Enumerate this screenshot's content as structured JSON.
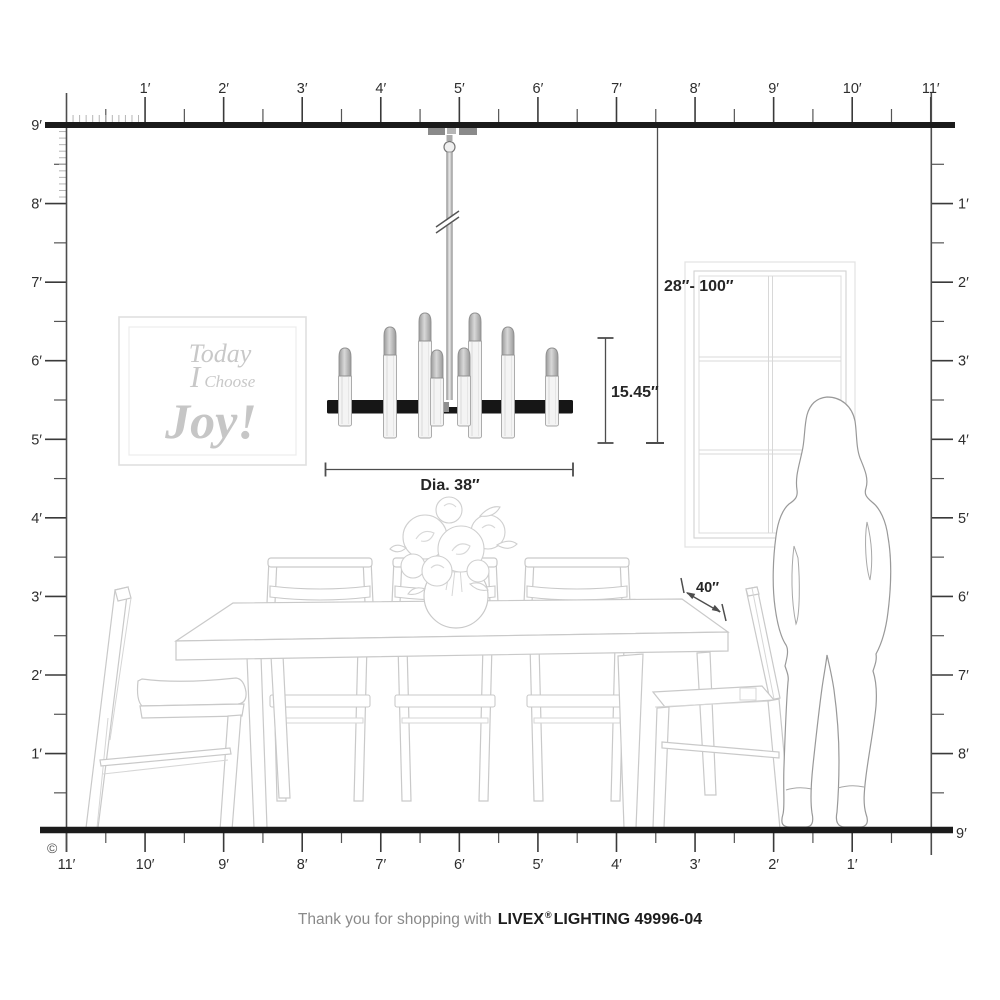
{
  "product": {
    "diagram_type": "chandelier room scale diagram",
    "room_height_feet": 9,
    "room_width_feet": 11
  },
  "rulers": {
    "top": [
      "1′",
      "2′",
      "3′",
      "4′",
      "5′",
      "6′",
      "7′",
      "8′",
      "9′",
      "10′",
      "11′"
    ],
    "left": [
      "9′",
      "8′",
      "7′",
      "6′",
      "5′",
      "4′",
      "3′",
      "2′",
      "1′"
    ],
    "right": [
      "1′",
      "2′",
      "3′",
      "4′",
      "5′",
      "6′",
      "7′",
      "8′",
      "9′"
    ],
    "bottom": [
      "11′",
      "10′",
      "9′",
      "8′",
      "7′",
      "6′",
      "5′",
      "4′",
      "3′",
      "2′",
      "1′"
    ],
    "bottom_right": "9′"
  },
  "dimensions": {
    "hanging_range": "28″- 100″",
    "fixture_height": "15.45″",
    "fixture_diameter": "Dia. 38″",
    "table_depth": "40″"
  },
  "wall_art": {
    "line1": "Today",
    "line2_initial": "I",
    "line2_rest": "Choose",
    "line3": "Joy!"
  },
  "footer": {
    "prefix": "Thank you for shopping with",
    "brand": "LIVEX",
    "registered": "®",
    "rest": "LIGHTING 49996-04"
  },
  "copyright": "©",
  "colors": {
    "structure_line": "#1b1b1b",
    "ruler_line": "#4d4d4d",
    "tick_minor": "#b5b5b5",
    "dimension_line": "#4d4d4d",
    "furniture_line": "#c9c9c9",
    "art_text": "#c8c8c8",
    "fixture_bar": "#161616",
    "fixture_metal": "#9a9a9a"
  }
}
